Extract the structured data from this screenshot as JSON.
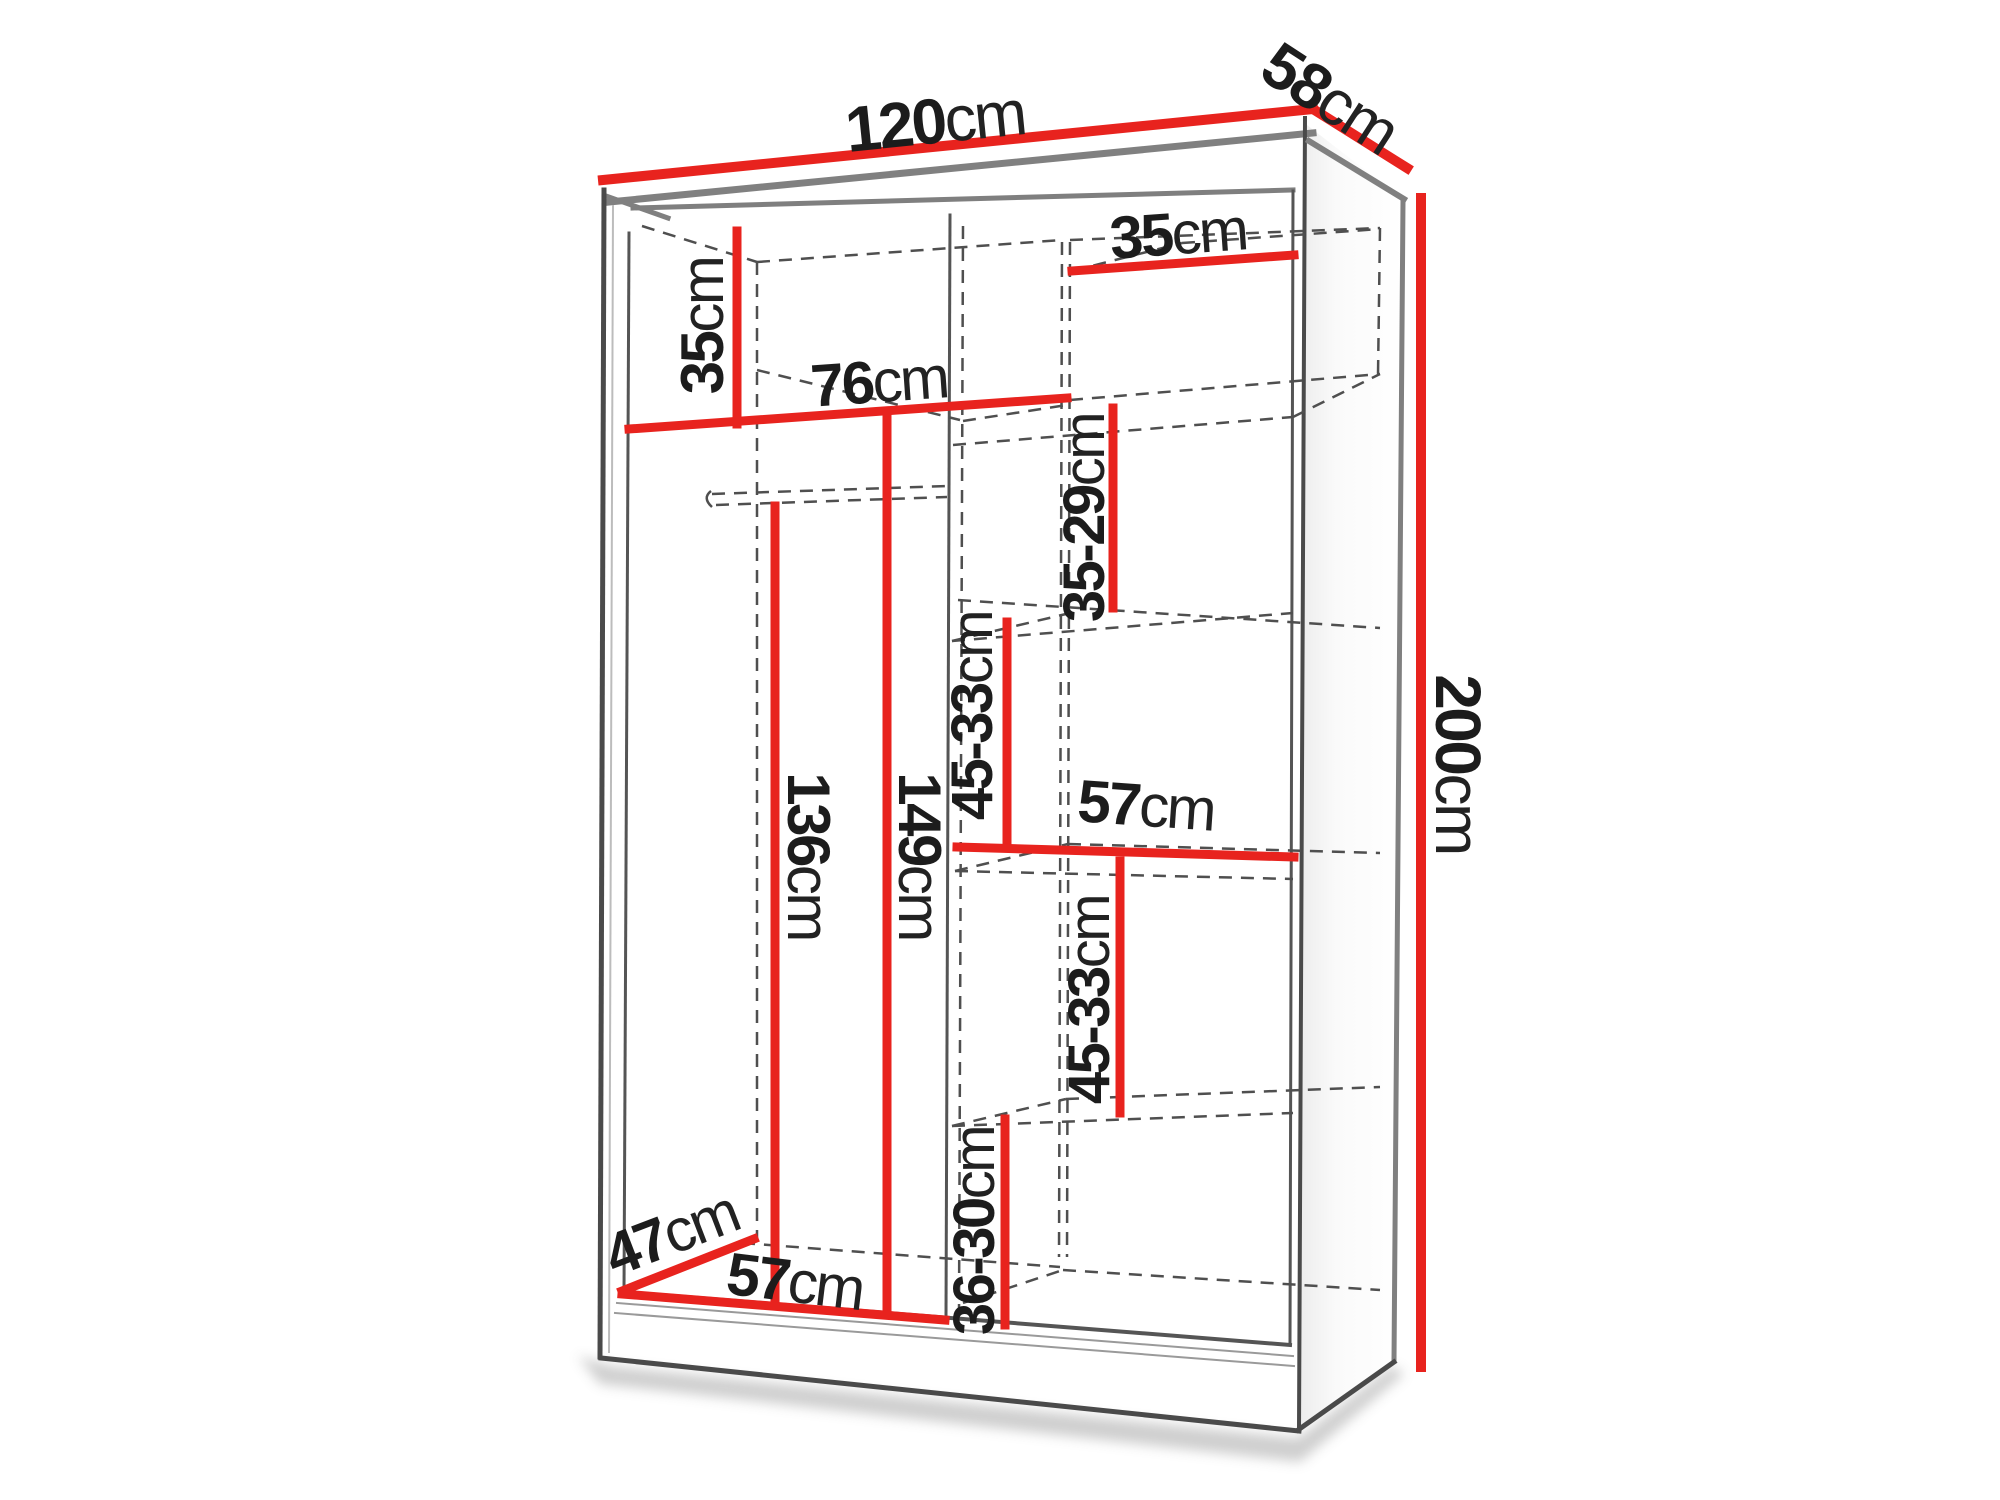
{
  "diagram": {
    "type": "wardrobe-dimension-drawing",
    "unit": "cm",
    "colors": {
      "dimension_line": "#e8231e",
      "outline_dark": "#4a4a4a",
      "outline_gray": "#808080",
      "hidden_edge": "#4f4f4f",
      "text": "#1c1c1c",
      "background": "#ffffff"
    },
    "dimensions": {
      "width_top": {
        "value": "120",
        "unit": "cm"
      },
      "depth_top": {
        "value": "58",
        "unit": "cm"
      },
      "height_side": {
        "value": "200",
        "unit": "cm"
      },
      "top_left_height": {
        "value": "35",
        "unit": "cm"
      },
      "top_shelf_width": {
        "value": "76",
        "unit": "cm"
      },
      "top_right_width": {
        "value": "35",
        "unit": "cm"
      },
      "upper_right_height": {
        "value": "35-29",
        "unit": "cm"
      },
      "mid_right_height_a": {
        "value": "45-33",
        "unit": "cm"
      },
      "middle_shelf_width": {
        "value": "57",
        "unit": "cm"
      },
      "hanging_height": {
        "value": "136",
        "unit": "cm"
      },
      "left_interior_height": {
        "value": "149",
        "unit": "cm"
      },
      "mid_right_height_b": {
        "value": "45-33",
        "unit": "cm"
      },
      "bottom_right_height": {
        "value": "36-30",
        "unit": "cm"
      },
      "bottom_depth": {
        "value": "47",
        "unit": "cm"
      },
      "bottom_width": {
        "value": "57",
        "unit": "cm"
      }
    }
  }
}
